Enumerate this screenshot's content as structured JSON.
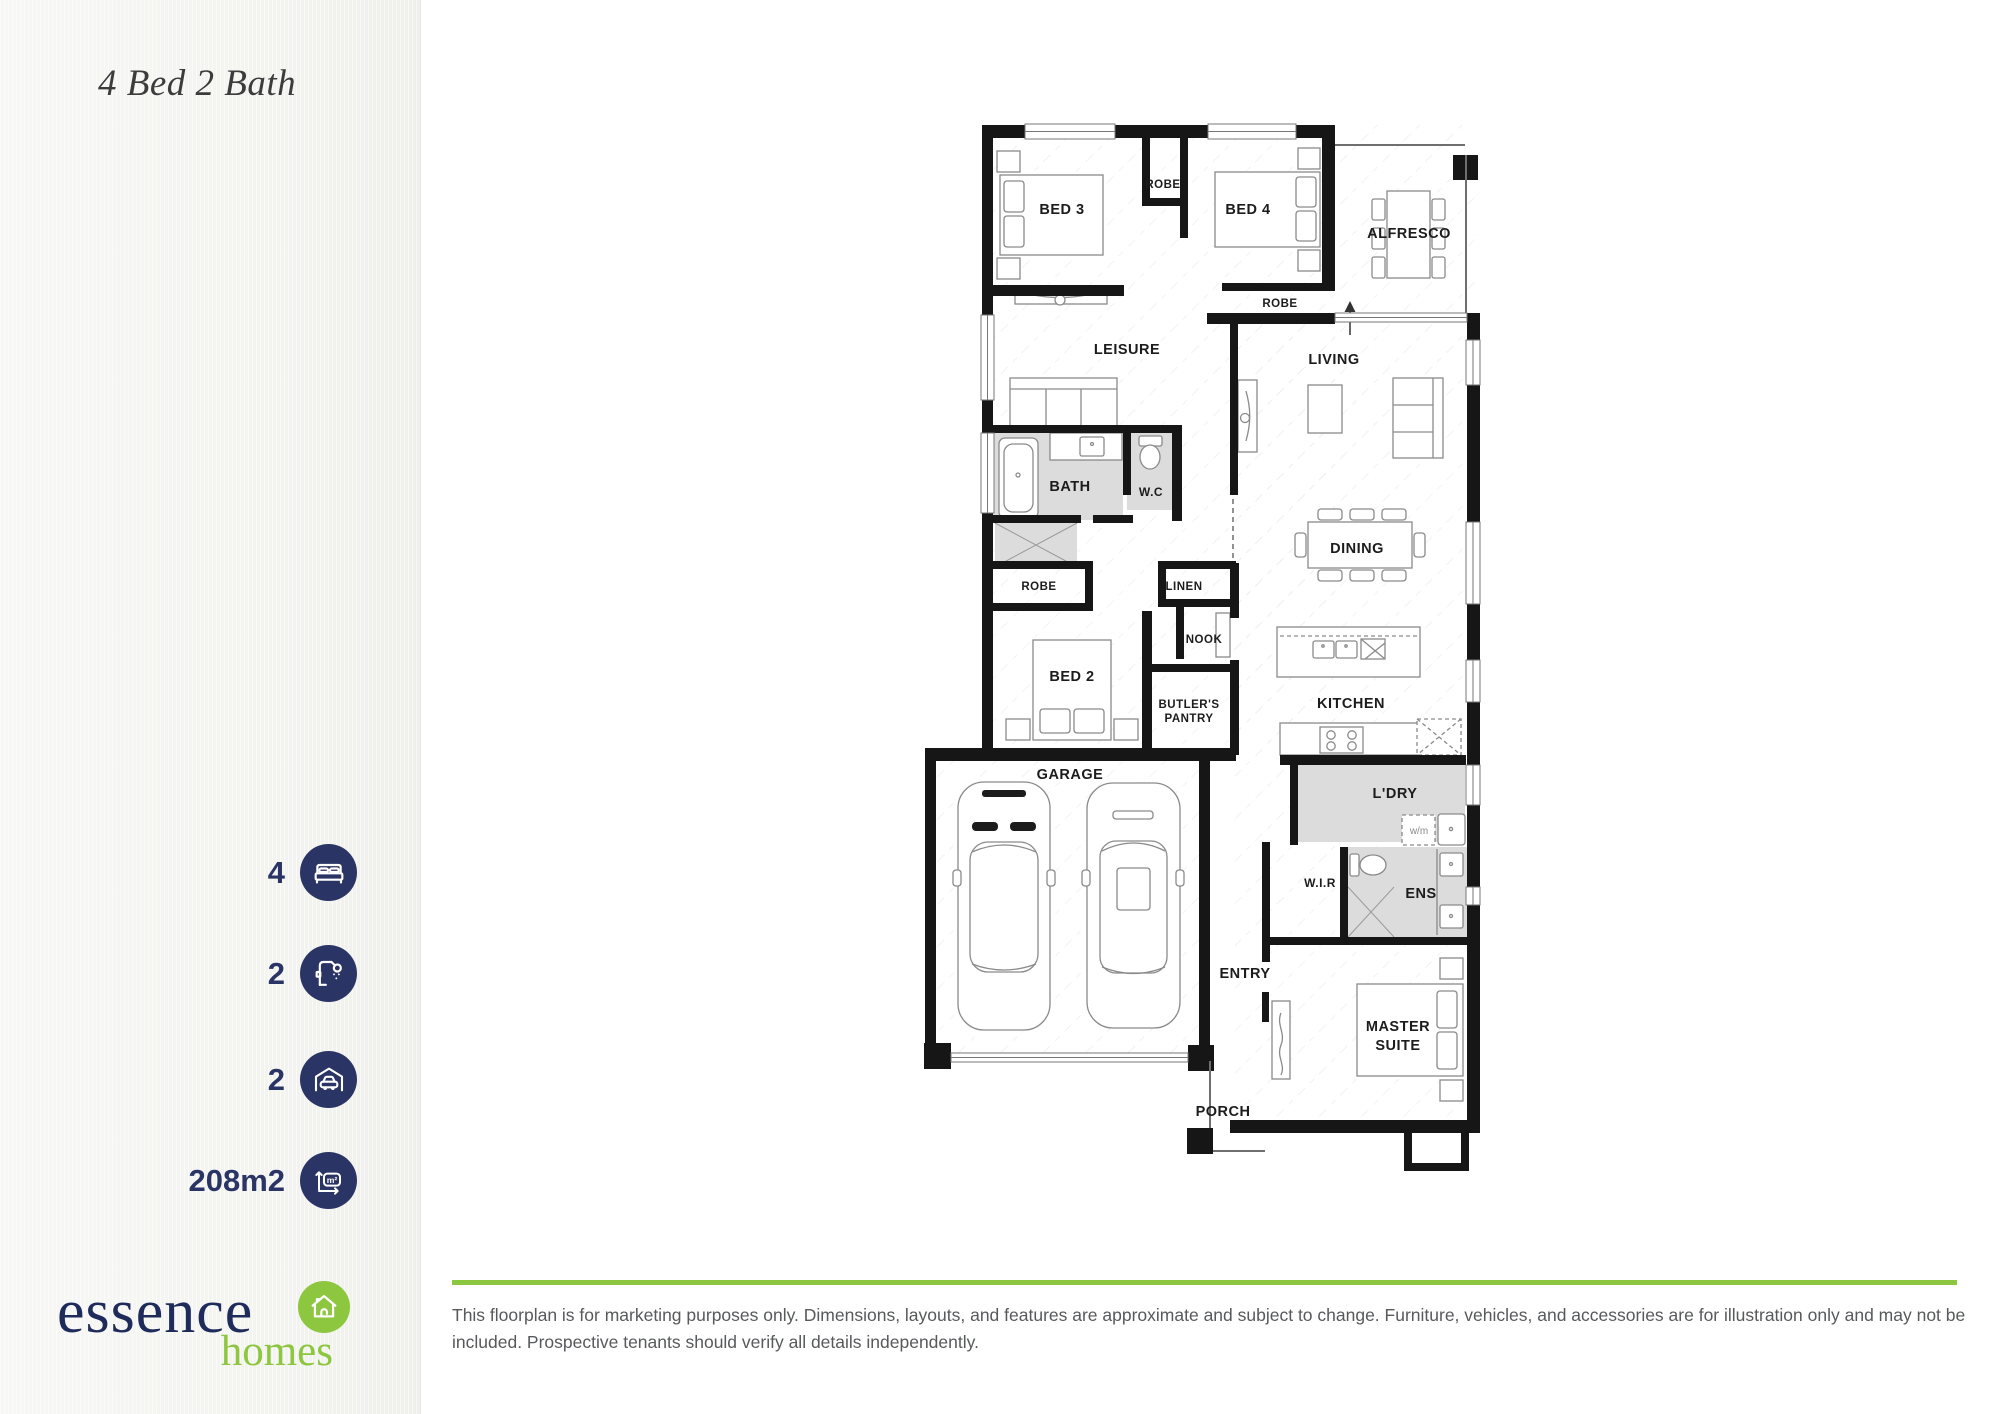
{
  "sidebar": {
    "title": "4 Bed 2 Bath",
    "stats": [
      {
        "icon": "bed-icon",
        "value": "4"
      },
      {
        "icon": "shower-icon",
        "value": "2"
      },
      {
        "icon": "garage-icon",
        "value": "2"
      },
      {
        "icon": "area-icon",
        "value": "208m2"
      }
    ],
    "area_icon_text": "m²",
    "logo": {
      "name": "essence",
      "tagline": "homes"
    }
  },
  "floorplan": {
    "rooms": {
      "bed3": "BED 3",
      "robe_top": "ROBE",
      "bed4": "BED 4",
      "alfresco": "ALFRESCO",
      "leisure": "LEISURE",
      "living": "LIVING",
      "bath": "BATH",
      "wc": "W.C",
      "dining": "DINING",
      "robe_bed4": "ROBE",
      "robe_bed2": "ROBE",
      "linen": "LINEN",
      "nook": "NOOK",
      "bed2": "BED 2",
      "butlers_line1": "BUTLER'S",
      "butlers_line2": "PANTRY",
      "kitchen": "KITCHEN",
      "garage": "GARAGE",
      "laundry": "L'DRY",
      "washing_machine": "w/m",
      "wir": "W.I.R",
      "ens": "ENS",
      "entry": "ENTRY",
      "master_line1": "MASTER",
      "master_line2": "SUITE",
      "porch": "PORCH"
    }
  },
  "footer": {
    "disclaimer": "This floorplan is for marketing purposes only. Dimensions, layouts, and features are approximate and subject to change. Furniture, vehicles, and accessories are for illustration only and may not be included. Prospective tenants should verify all details independently."
  },
  "colors": {
    "navy": "#2a3565",
    "green": "#8dc63f"
  }
}
